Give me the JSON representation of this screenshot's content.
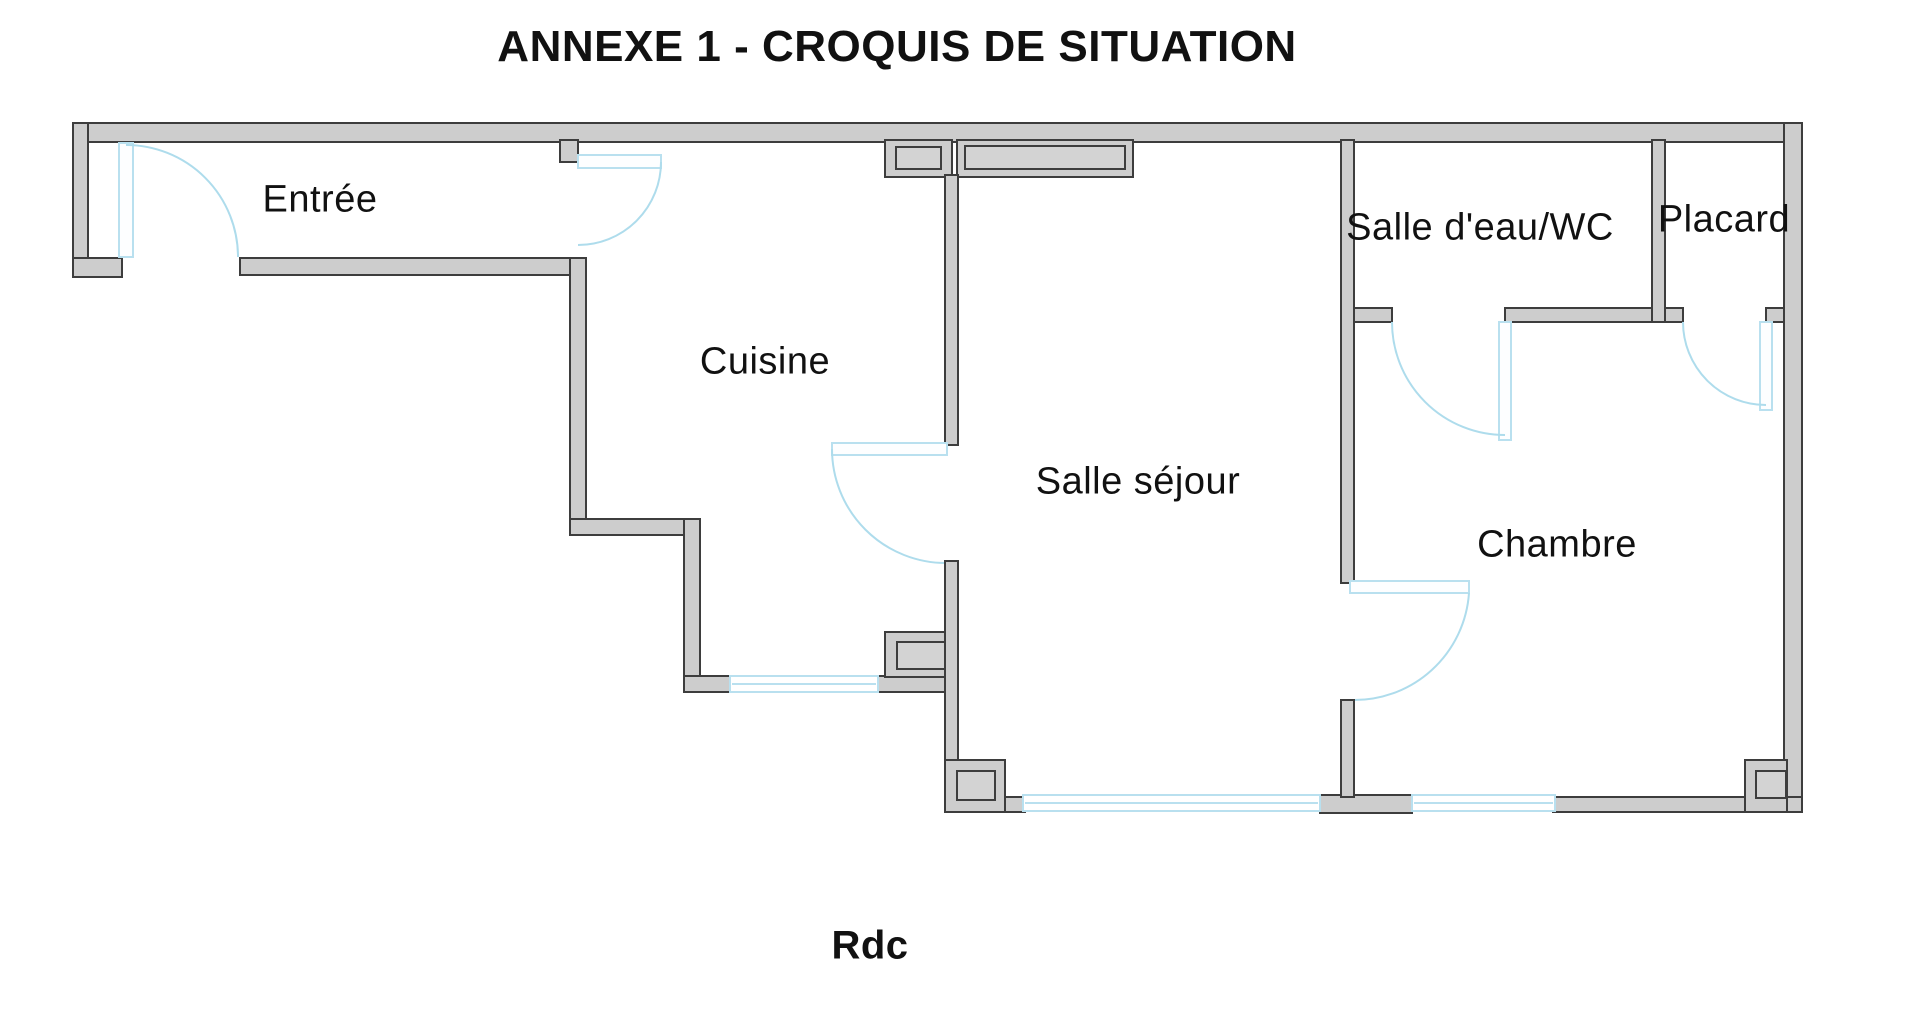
{
  "title": "ANNEXE 1 - CROQUIS DE SITUATION",
  "floor_label": "Rdc",
  "rooms": [
    {
      "id": "entree",
      "label": "Entrée"
    },
    {
      "id": "cuisine",
      "label": "Cuisine"
    },
    {
      "id": "salle-sejour",
      "label": "Salle séjour"
    },
    {
      "id": "salle-deau-wc",
      "label": "Salle d'eau/WC"
    },
    {
      "id": "placard",
      "label": "Placard"
    },
    {
      "id": "chambre",
      "label": "Chambre"
    }
  ],
  "colors": {
    "wall_fill": "#cdcdcd",
    "wall_stroke": "#3d3d3d",
    "inner_fill": "#d3d3d3",
    "door_swing": "#aedcec",
    "window_blue": "#b9e0ef",
    "text": "#111111",
    "background": "#ffffff"
  }
}
